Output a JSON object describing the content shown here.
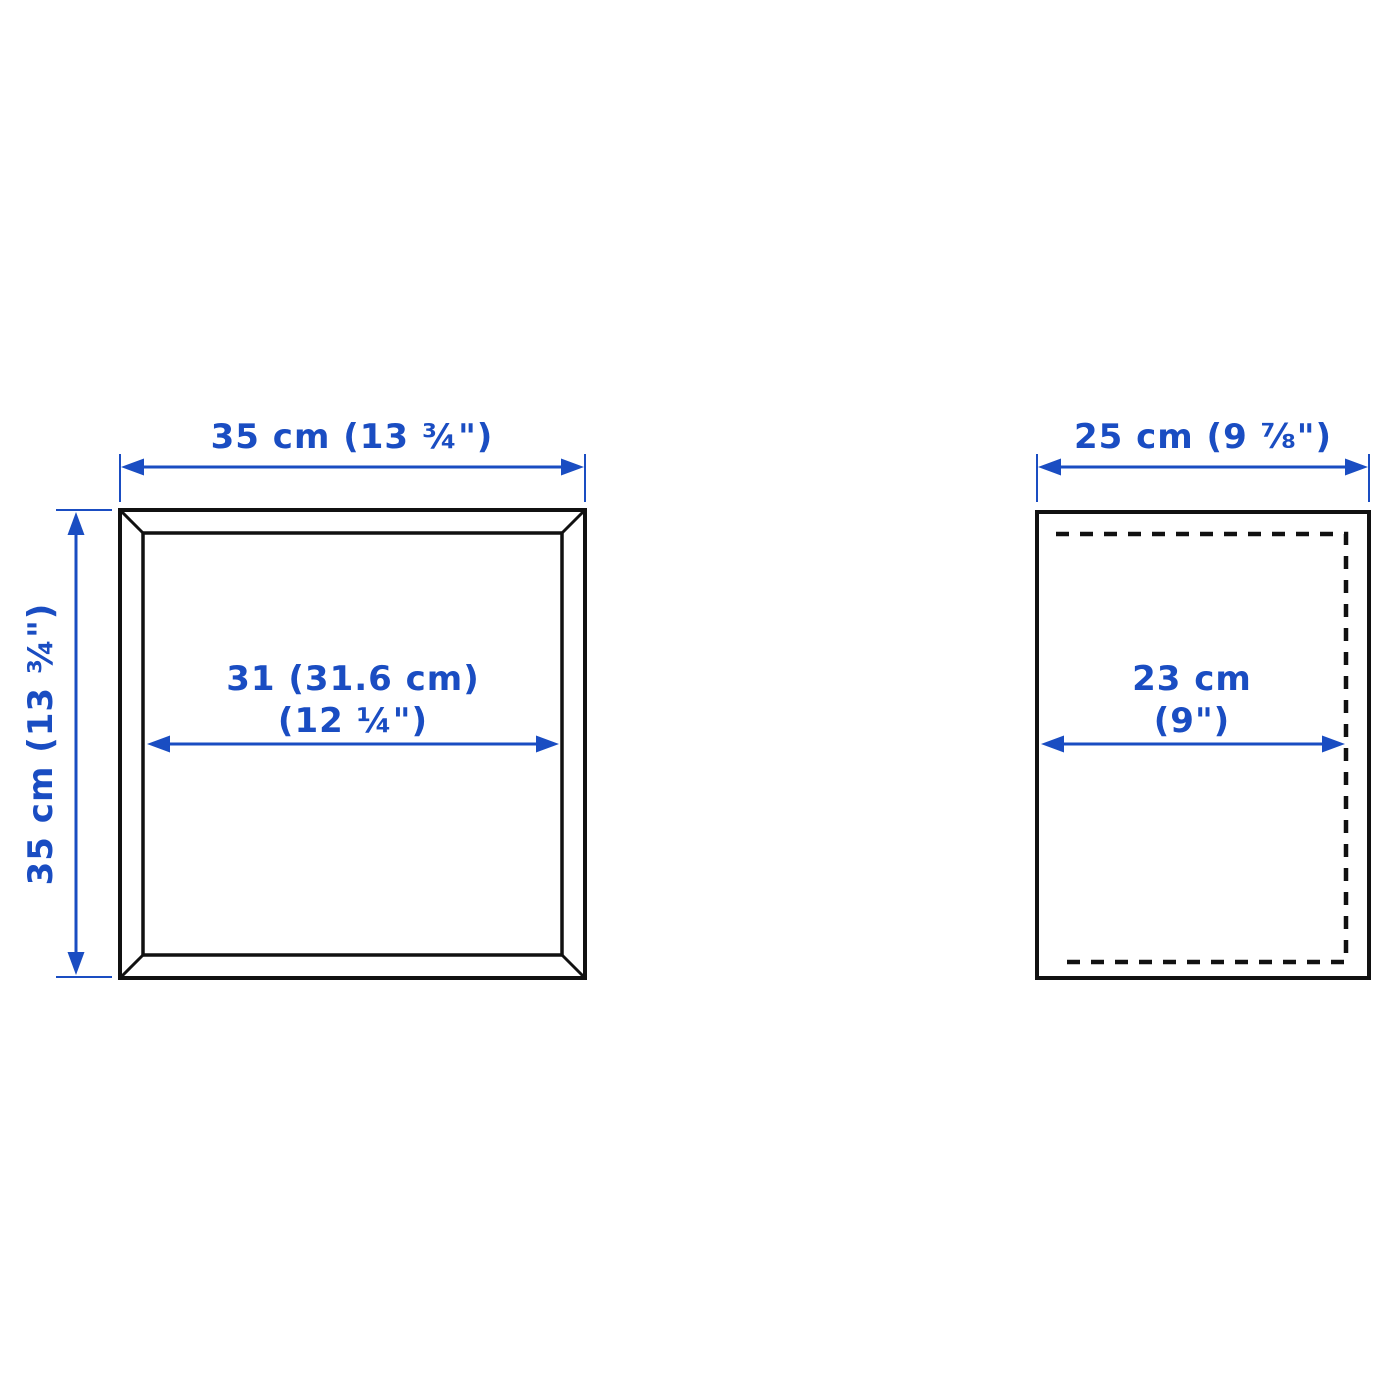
{
  "diagram": {
    "type": "product-dimension-diagram",
    "views": {
      "front_view": {
        "name": "front view",
        "width_label": "35 cm (13 ¾\")",
        "height_label": "35 cm (13 ¾\")",
        "inner_width_label_line1": "31 (31.6 cm)",
        "inner_width_label_line2": "(12 ¼\")"
      },
      "side_view": {
        "name": "side view",
        "depth_label": "25 cm (9 ⅞\")",
        "inner_depth_label_line1": "23 cm",
        "inner_depth_label_line2": "(9\")"
      }
    },
    "colors": {
      "dimension_blue": "#1a4dc2",
      "outline_black": "#111111",
      "background": "#ffffff"
    }
  }
}
